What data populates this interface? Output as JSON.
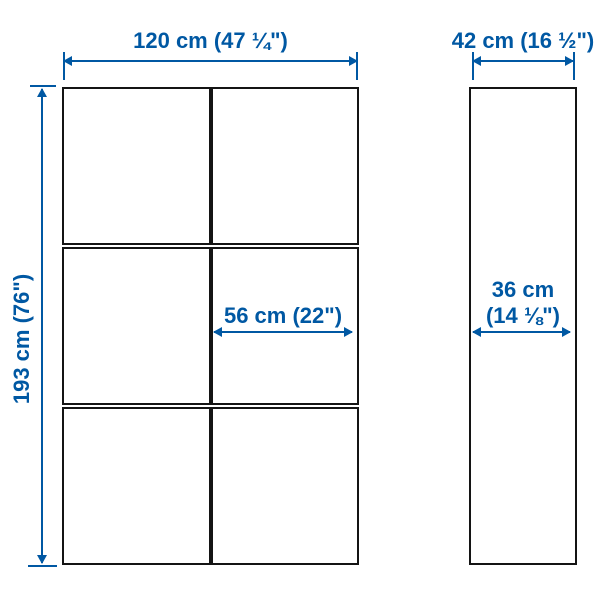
{
  "diagram": {
    "front_view": {
      "width_label": "120 cm (47 ¼\")",
      "height_label": "193 cm (76\")",
      "door_width_label": "56 cm (22\")"
    },
    "side_view": {
      "depth_label": "42 cm (16 ½\")",
      "inner_depth_line1": "36 cm",
      "inner_depth_line2": "(14 ⅛\")"
    },
    "grid": {
      "columns": 2,
      "rows": 3
    }
  },
  "colors": {
    "dimension-blue": "#0058A3",
    "outline-black": "#141414",
    "background": "#ffffff"
  }
}
